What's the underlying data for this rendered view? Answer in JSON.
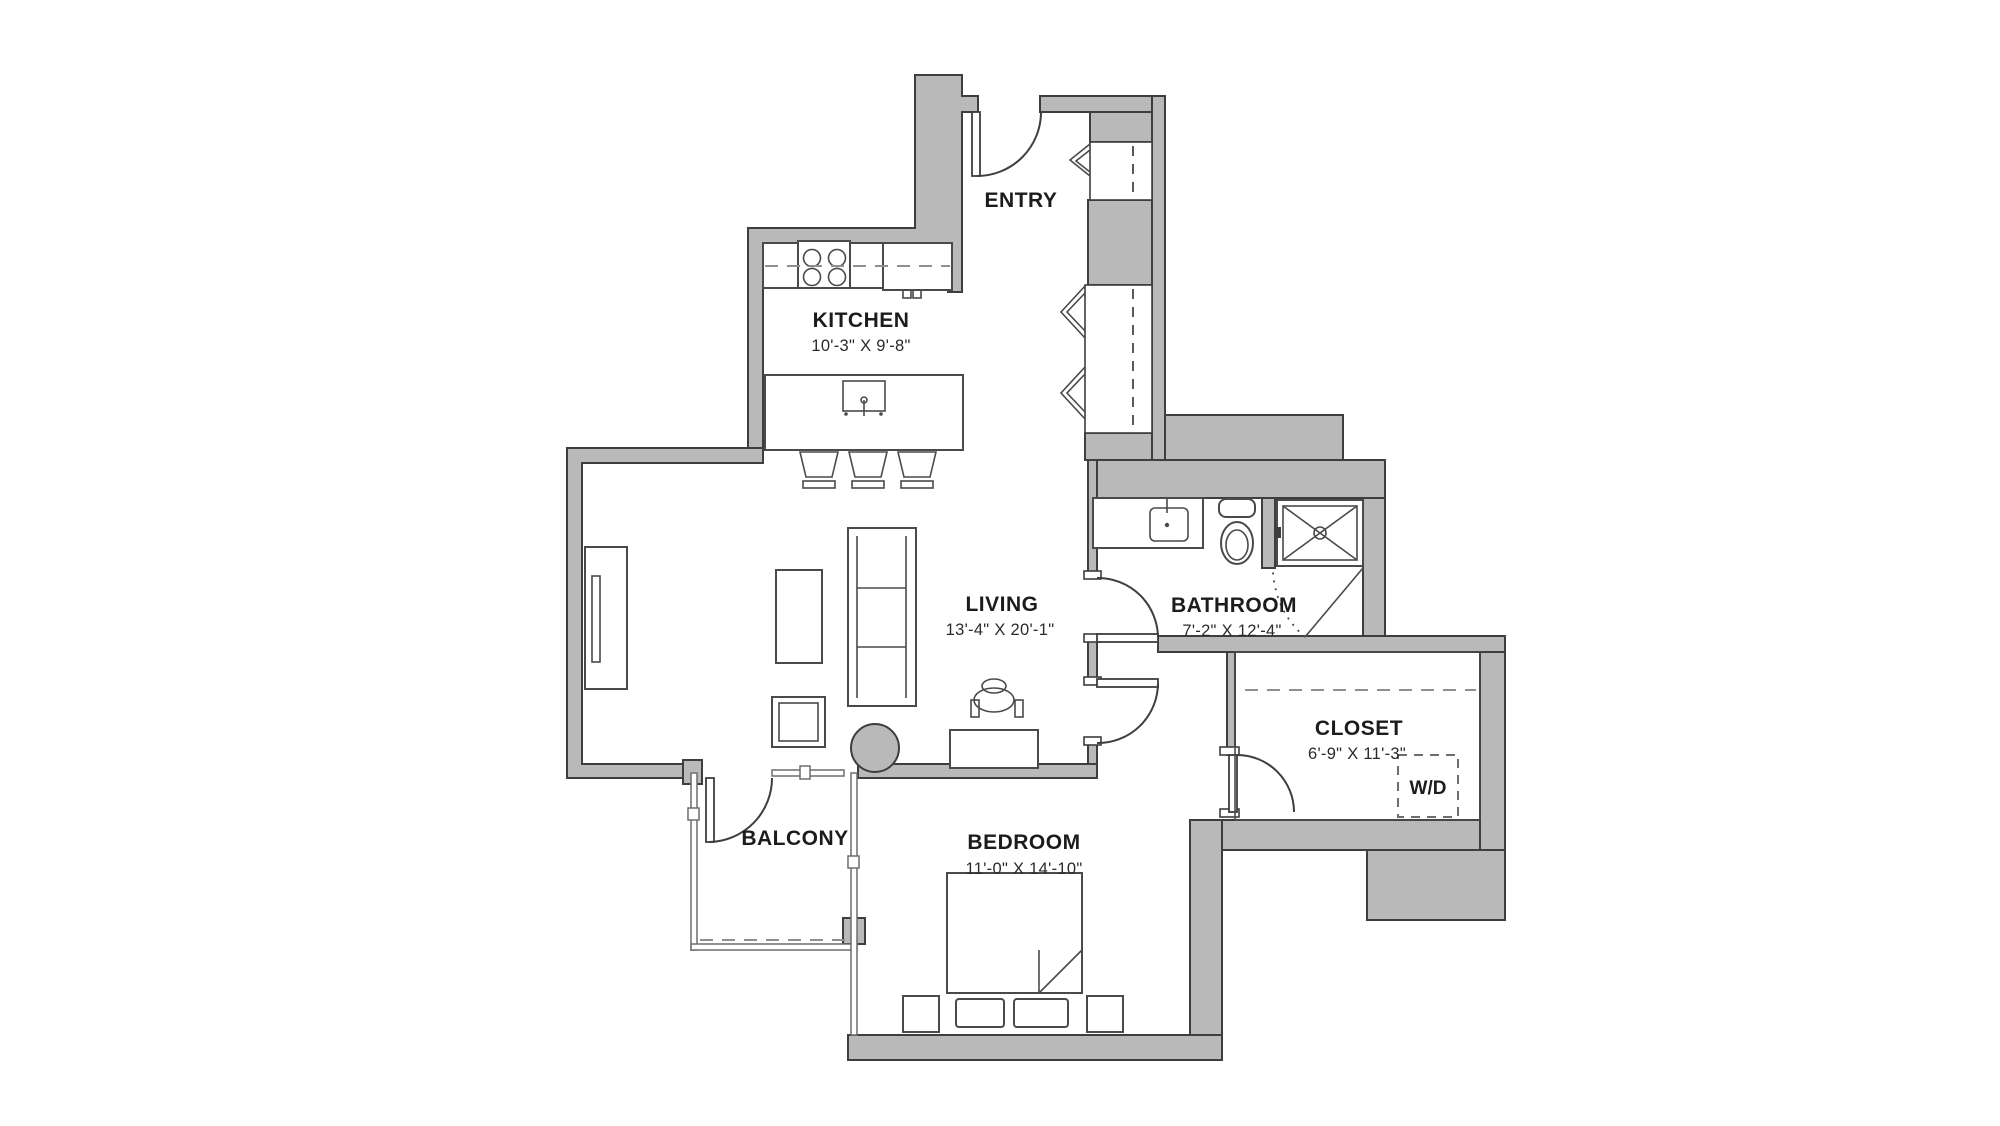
{
  "rooms": {
    "entry": {
      "name": "ENTRY"
    },
    "kitchen": {
      "name": "KITCHEN",
      "dims": "10'-3\" X 9'-8\""
    },
    "living": {
      "name": "LIVING",
      "dims": "13'-4\" X 20'-1\""
    },
    "bathroom": {
      "name": "BATHROOM",
      "dims": "7'-2\" X 12'-4\""
    },
    "closet": {
      "name": "CLOSET",
      "dims": "6'-9\" X 11'-3\""
    },
    "bedroom": {
      "name": "BEDROOM",
      "dims": "11'-0\" X 14'-10\""
    },
    "balcony": {
      "name": "BALCONY"
    },
    "washer_dryer": {
      "label": "W/D"
    }
  },
  "colors": {
    "wall_fill": "#b9b9b9",
    "wall_outline": "#3e3e3e",
    "fixture_line": "#4a4a4a",
    "label_text": "#1c1c1c"
  }
}
